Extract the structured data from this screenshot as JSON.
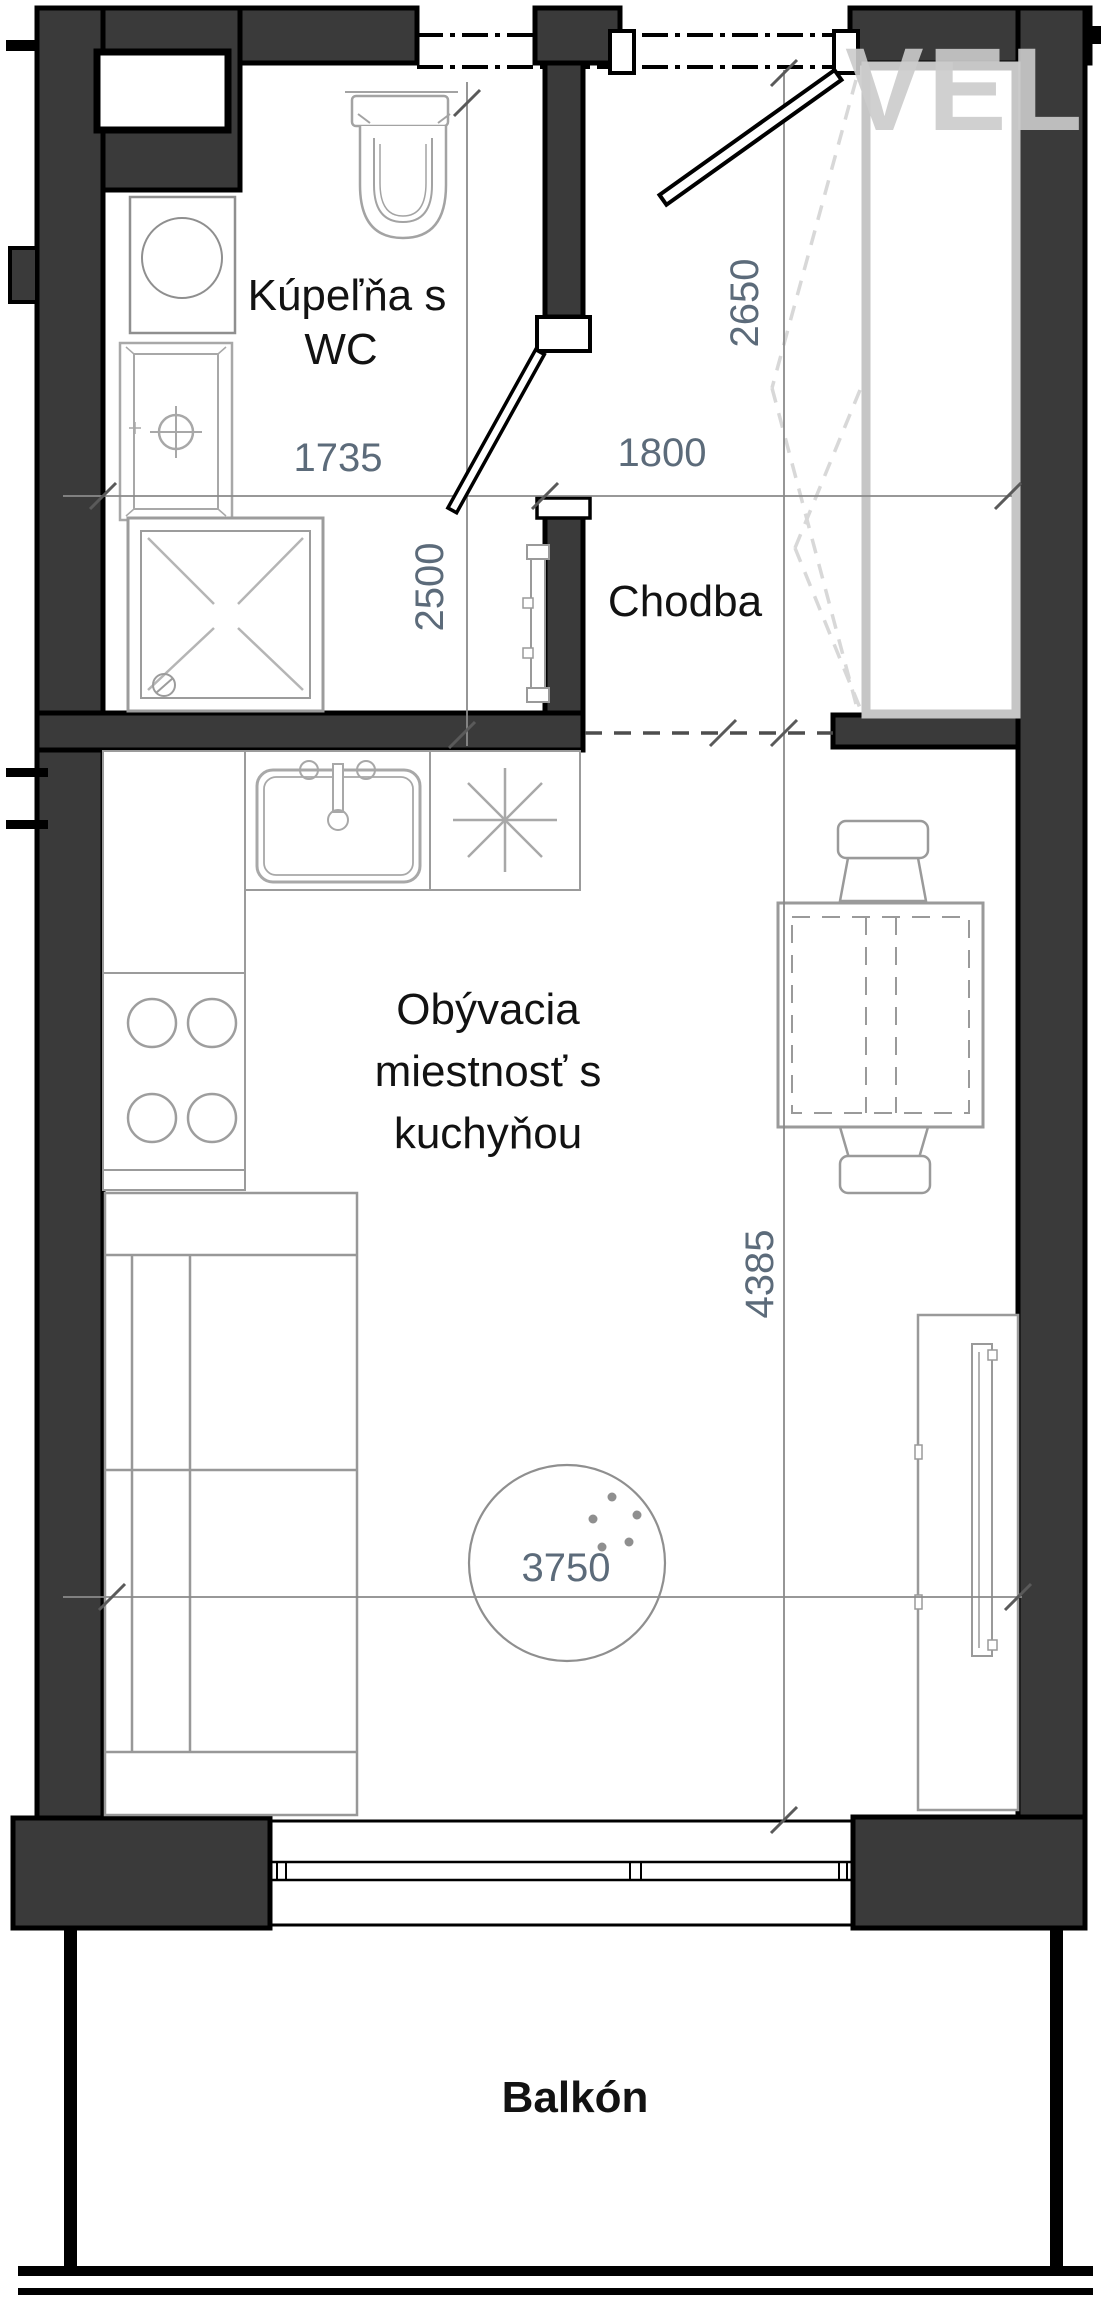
{
  "watermark": {
    "text": "VEL"
  },
  "rooms": {
    "bathroom": {
      "line1": "Kúpeľňa s",
      "line2": "WC"
    },
    "hallway": {
      "label": "Chodba"
    },
    "living": {
      "line1": "Obývacia",
      "line2": "miestnosť s",
      "line3": "kuchyňou"
    },
    "balcony": {
      "label": "Balkón"
    }
  },
  "dimensions": {
    "bathroom_width": "1735",
    "bathroom_depth": "2500",
    "hallway_width": "1800",
    "entry_depth": "2650",
    "living_depth": "4385",
    "ceiling_height": "3750"
  },
  "colors": {
    "wall_fill": "#3a3a3a",
    "wall_outline": "#000000",
    "fixture_stroke": "#a0a0a0",
    "furniture_stroke": "#9a9a9a",
    "dimension_color": "#5c6b7a",
    "dimension_line": "#8a8a8a",
    "watermark_color": "#cccccc"
  }
}
